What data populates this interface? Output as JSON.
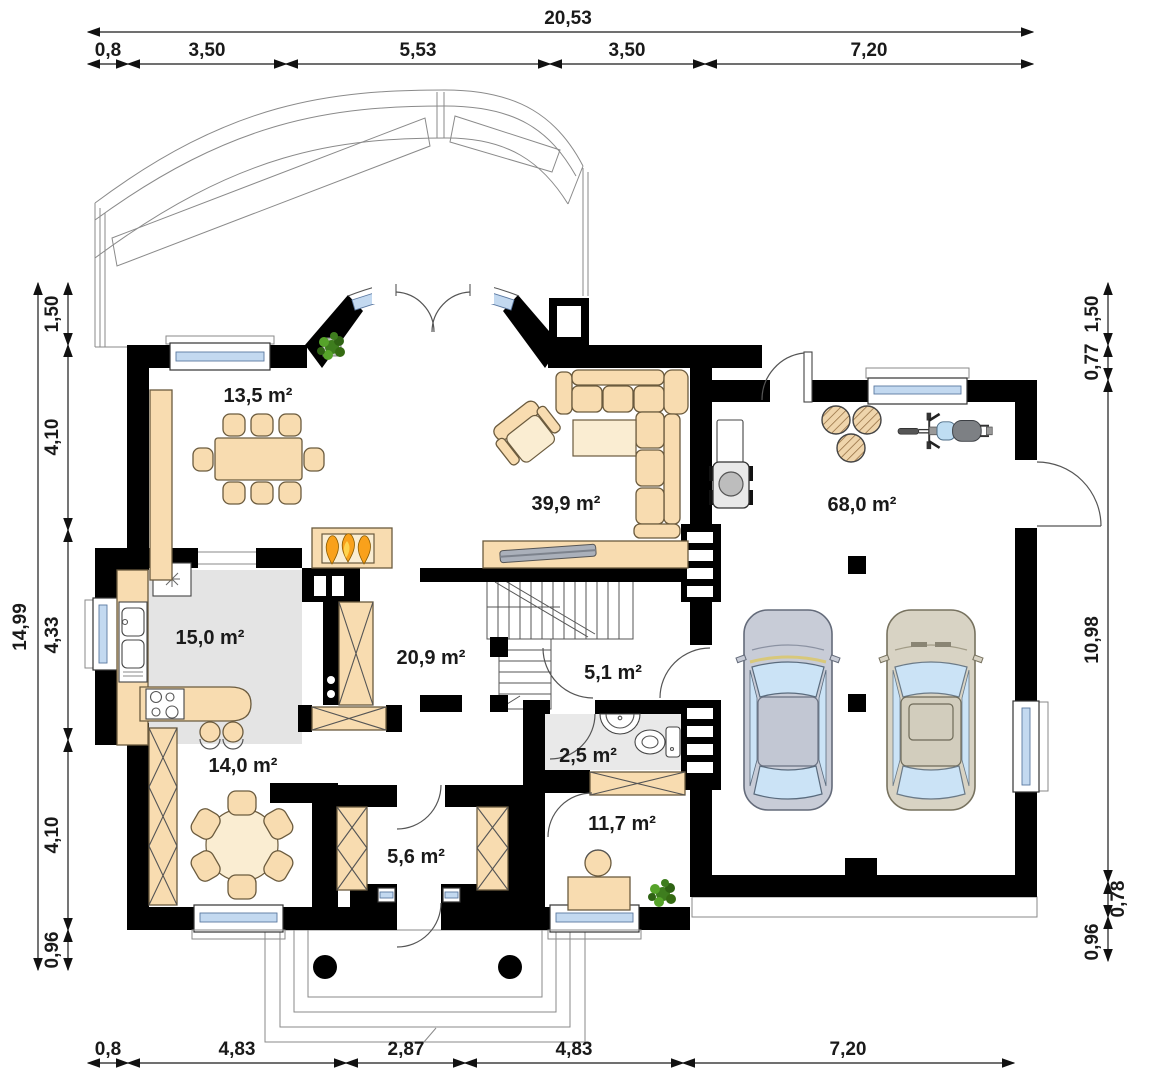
{
  "plan": {
    "rooms": {
      "dining": "13,5 m²",
      "living": "39,9 m²",
      "garage": "68,0 m²",
      "kitchen": "15,0 m²",
      "hall": "20,9 m²",
      "corridor": "5,1 m²",
      "wc": "2,5 m²",
      "bedroom": "14,0 m²",
      "vestibule": "5,6 m²",
      "office": "11,7 m²"
    },
    "dimensions": {
      "top_total": "20,53",
      "top": [
        "0,8",
        "3,50",
        "5,53",
        "3,50",
        "7,20"
      ],
      "bottom": [
        "0,8",
        "4,83",
        "2,87",
        "4,83",
        "7,20"
      ],
      "left_total": "14,99",
      "left": [
        "1,50",
        "4,10",
        "4,33",
        "4,10",
        "0,96"
      ],
      "right": [
        "1,50",
        "0,77",
        "10,98",
        "0,78",
        "0,96"
      ]
    },
    "colors": {
      "wall": "#000000",
      "furniture": "#F8DCB0",
      "furniture_light": "#FAEDD2",
      "window": "#C3D9F0",
      "floor": "#E4E4E4",
      "flame": "#F9A11B",
      "plant": "#3E7D1E",
      "car_gray": "#C8CCD7",
      "car_beige": "#D8D3C4"
    }
  }
}
